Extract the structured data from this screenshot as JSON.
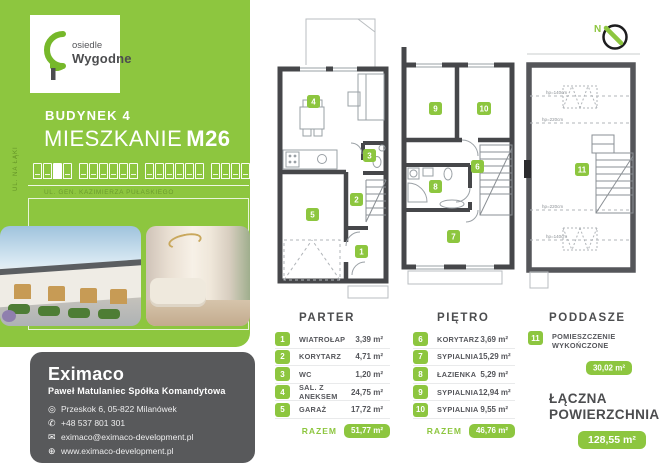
{
  "colors": {
    "green": "#8dc63f",
    "dark_wall": "#46474a",
    "attic_wall": "#55565a",
    "gray_box": "#58595b"
  },
  "brand": {
    "logo_line1": "osiedle",
    "logo_line2": "Wygodne"
  },
  "sidebar": {
    "building": "BUDYNEK 4",
    "apartment_label": "MIESZKANIE",
    "apartment_number": "M26",
    "street_side": "UL. NA ŁĄKI",
    "street_bottom": "UL. GEN. KAZIMIERZA PUŁASKIEGO"
  },
  "contact": {
    "company": "Eximaco",
    "subtitle": "Paweł Matulaniec Spółka Komandytowa",
    "address": "Przeskok 6, 05-822 Milanówek",
    "phone": "+48 537 801 301",
    "email": "eximaco@eximaco-development.pl",
    "website": "www.eximaco-development.pl"
  },
  "icons": {
    "location": "◎",
    "phone": "✆",
    "email": "✉",
    "website": "⊕"
  },
  "floors": [
    {
      "name": "PARTER",
      "rooms": [
        {
          "no": "1",
          "label": "WIATROŁAP",
          "area": "3,39 m²"
        },
        {
          "no": "2",
          "label": "KORYTARZ",
          "area": "4,71 m²"
        },
        {
          "no": "3",
          "label": "WC",
          "area": "1,20 m²"
        },
        {
          "no": "4",
          "label": "SAL. Z ANEKSEM",
          "area": "24,75 m²"
        },
        {
          "no": "5",
          "label": "GARAŻ",
          "area": "17,72 m²"
        }
      ],
      "total_label": "RAZEM",
      "total": "51,77 m²"
    },
    {
      "name": "PIĘTRO",
      "rooms": [
        {
          "no": "6",
          "label": "KORYTARZ",
          "area": "3,69 m²"
        },
        {
          "no": "7",
          "label": "SYPIALNIA",
          "area": "15,29 m²"
        },
        {
          "no": "8",
          "label": "ŁAZIENKA",
          "area": "5,29 m²"
        },
        {
          "no": "9",
          "label": "SYPIALNIA",
          "area": "12,94 m²"
        },
        {
          "no": "10",
          "label": "SYPIALNIA",
          "area": "9,55 m²"
        }
      ],
      "total_label": "RAZEM",
      "total": "46,76 m²"
    },
    {
      "name": "PODDASZE",
      "rooms": [
        {
          "no": "11",
          "label": "POMIESZCZENIE WYKOŃCZONE",
          "area": "30,02 m²"
        }
      ]
    }
  ],
  "summary": {
    "label": "ŁĄCZNA POWIERZCHNIA",
    "value": "128,55 m²"
  },
  "plan_annotations": {
    "compass": "N",
    "hp140": "hp=140cm",
    "hp220": "hp=220cm"
  }
}
